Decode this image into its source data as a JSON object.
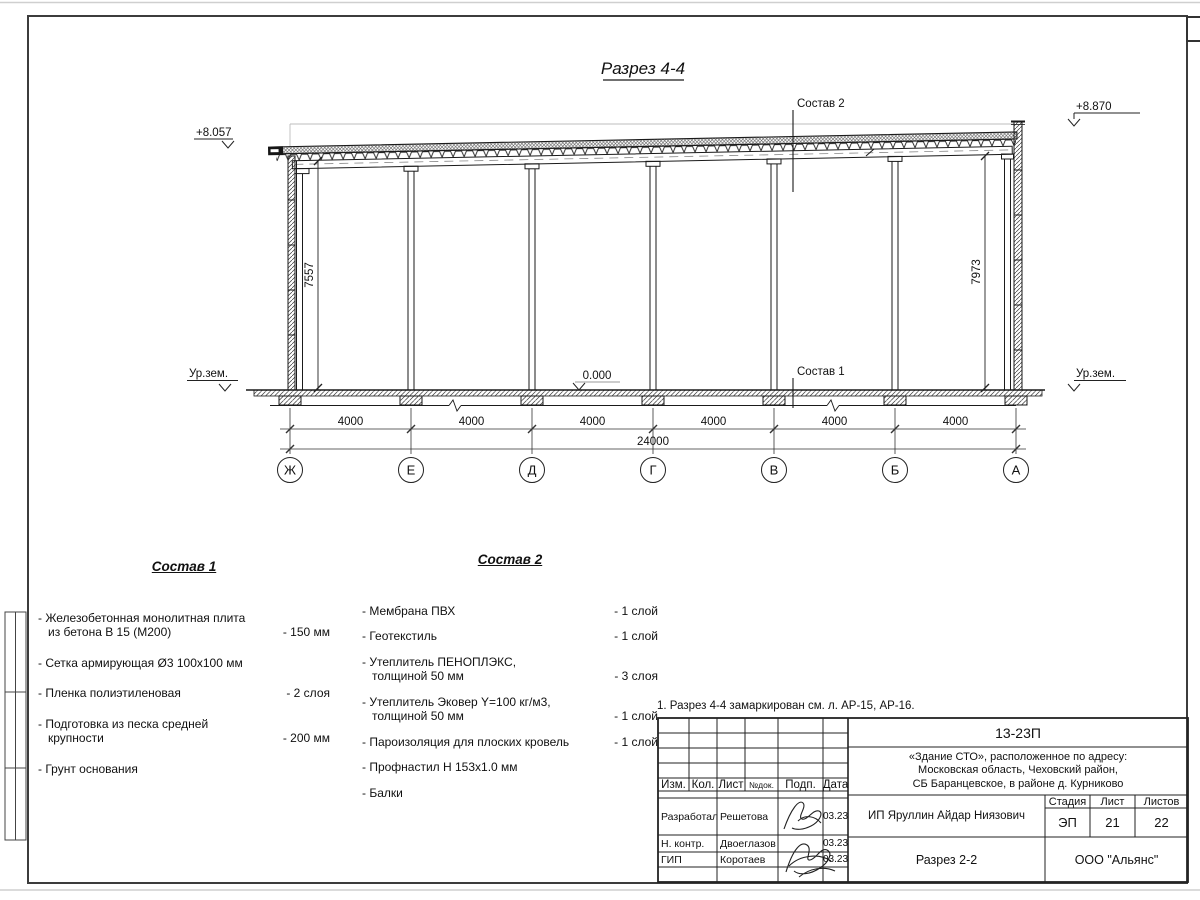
{
  "page": {
    "title": "Разрез 4-4",
    "note": "1. Разрез 4-4 замаркирован см. л. АР-15, АР-16."
  },
  "drawing": {
    "elevation_left": "+8.057",
    "elevation_right": "+8.870",
    "elevation_zero": "0.000",
    "ground_left": "Ур.зем.",
    "ground_right": "Ур.зем.",
    "height_left": "7557",
    "height_right": "7973",
    "leader_roof": "Состав 2",
    "leader_floor": "Состав 1",
    "axes": [
      "Ж",
      "Е",
      "Д",
      "Г",
      "В",
      "Б",
      "А"
    ],
    "dims": {
      "bays": [
        "4000",
        "4000",
        "4000",
        "4000",
        "4000",
        "4000"
      ],
      "total": "24000"
    }
  },
  "sostav1": {
    "title": "Состав 1",
    "items": [
      {
        "name": "- Железобетонная  монолитная плита\nиз бетона В 15 (М200)",
        "value": "- 150 мм"
      },
      {
        "name": "- Сетка армирующая Ø3 100х100 мм",
        "value": ""
      },
      {
        "name": "- Пленка полиэтиленовая",
        "value": "- 2 слоя"
      },
      {
        "name": "- Подготовка из песка средней\nкрупности",
        "value": "- 200 мм"
      },
      {
        "name": "- Грунт основания",
        "value": ""
      }
    ]
  },
  "sostav2": {
    "title": "Состав 2",
    "items": [
      {
        "name": "- Мембрана ПВХ",
        "value": "- 1 слой"
      },
      {
        "name": "- Геотекстиль",
        "value": "- 1 слой"
      },
      {
        "name": "- Утеплитель ПЕНОПЛЭКС,\nтолщиной 50 мм",
        "value": "- 3 слоя"
      },
      {
        "name": "- Утеплитель Эковер Y=100 кг/м3,\nтолщиной 50 мм",
        "value": "- 1 слой"
      },
      {
        "name": "- Пароизоляция для плоских кровель",
        "value": "- 1 слой"
      },
      {
        "name": "- Профнастил Н 153х1.0 мм",
        "value": ""
      },
      {
        "name": "- Балки",
        "value": ""
      }
    ]
  },
  "titleblock": {
    "doc_number": "13-23П",
    "project": "«Здание СТО», расположенное по адресу:\nМосковская область, Чеховский район,\nСБ Баранцевское, в районе д. Курниково",
    "client": "ИП Яруллин Айдар Ниязович",
    "sheet_title": "Разрез 2-2",
    "company": "ООО \"Альянс\"",
    "stage_label": "Стадия",
    "sheet_label": "Лист",
    "sheets_label": "Листов",
    "stage": "ЭП",
    "sheet": "21",
    "sheets": "22",
    "cols": {
      "izm": "Изм.",
      "kol": "Кол.",
      "list": "Лист",
      "ndok": "№док.",
      "podp": "Подп.",
      "data": "Дата"
    },
    "rows": [
      {
        "role": "Разработал",
        "name": "Решетова",
        "date": "03.23"
      },
      {
        "role": "Н. контр.",
        "name": "Двоеглазов",
        "date": "03.23"
      },
      {
        "role": "ГИП",
        "name": "Коротаев",
        "date": "03.23"
      }
    ]
  }
}
